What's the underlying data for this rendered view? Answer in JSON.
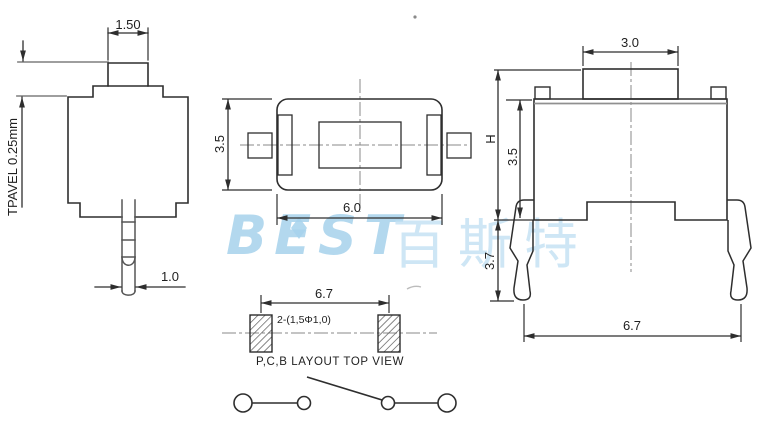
{
  "colors": {
    "line": "#2e2e2e",
    "watermark_blue": "#a6d2ec"
  },
  "watermark": {
    "logo": "BEST",
    "cjk": "百斯特"
  },
  "side_view": {
    "button_width": "1.50",
    "travel_label": "TPAVEL 0.25mm",
    "pin_width": "1.0"
  },
  "top_view": {
    "height": "3.5",
    "width": "6.0"
  },
  "front_view": {
    "button_width": "3.0",
    "total_height_label": "H",
    "body_height": "3.5",
    "leg_length": "3.7",
    "lead_span": "6.7"
  },
  "pcb_view": {
    "pitch": "6.7",
    "hole_note": "2-(1,5Φ1,0)",
    "caption": "P,C,B LAYOUT TOP VIEW"
  }
}
